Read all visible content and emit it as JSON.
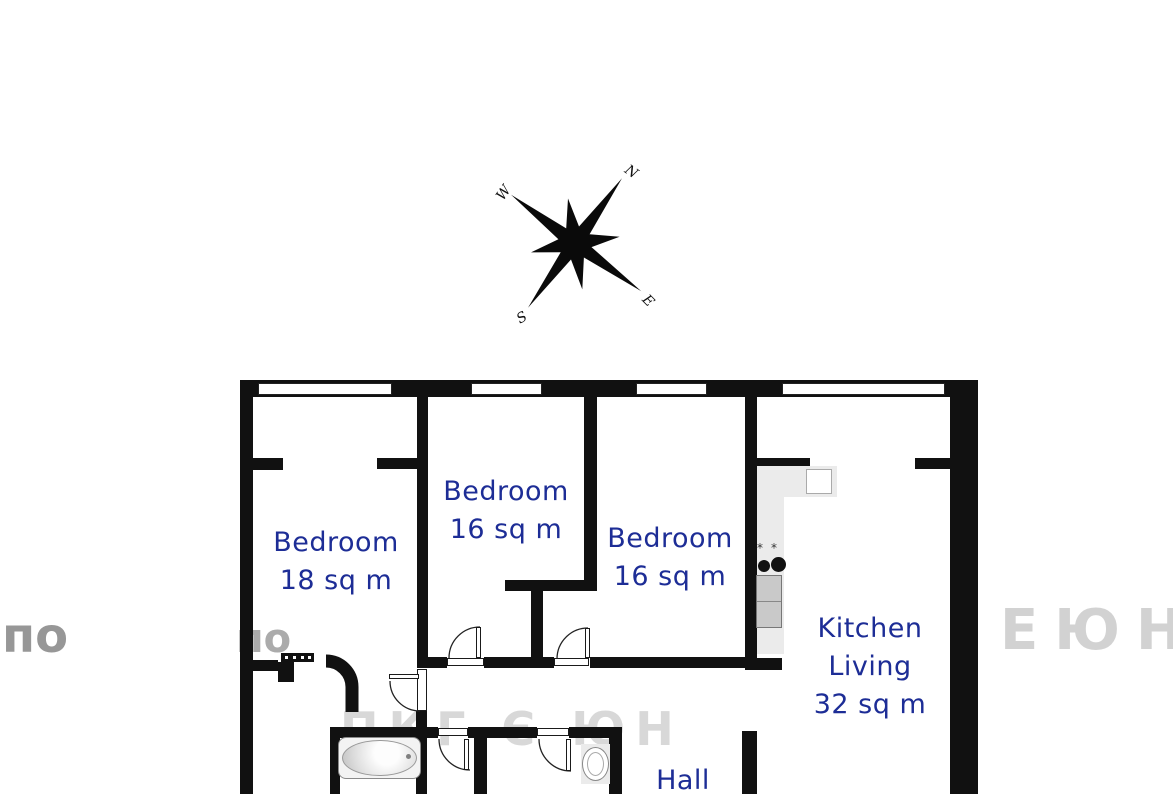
{
  "title": "Apartment floor plan",
  "rooms": {
    "bedroom1": {
      "name": "Bedroom",
      "area": "18 sq m"
    },
    "bedroom2": {
      "name": "Bedroom",
      "area": "16 sq m"
    },
    "bedroom3": {
      "name": "Bedroom",
      "area": "16 sq m"
    },
    "kitchen": {
      "line1": "Kitchen",
      "line2": "Living",
      "area": "32 sq m"
    },
    "hall": {
      "name": "Hall"
    }
  },
  "compass": {
    "north": "N",
    "south": "S",
    "east": "E",
    "west": "W"
  },
  "watermark": {
    "left": "по",
    "left2": "по",
    "right": "ЕЮН",
    "bottom": "ПКГ Є ЮН"
  },
  "colors": {
    "wall": "#111111",
    "label": "#1d2d96",
    "counter": "#ebebeb"
  }
}
